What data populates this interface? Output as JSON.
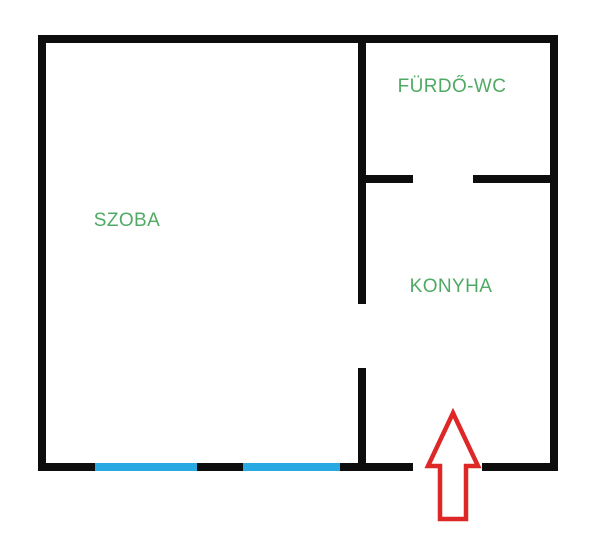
{
  "colors": {
    "background": "#ffffff",
    "wall": "#0d0d0d",
    "label": "#50aa64",
    "window": "#29a9e1",
    "arrow": "#de2727"
  },
  "rooms": [
    {
      "id": "szoba",
      "label": "SZOBA"
    },
    {
      "id": "furdo_wc",
      "label": "FÜRDŐ-WC"
    },
    {
      "id": "konyha",
      "label": "KONYHA"
    }
  ],
  "annotations": {
    "entrance_arrow_direction": "up",
    "window_segment_count": 2
  }
}
